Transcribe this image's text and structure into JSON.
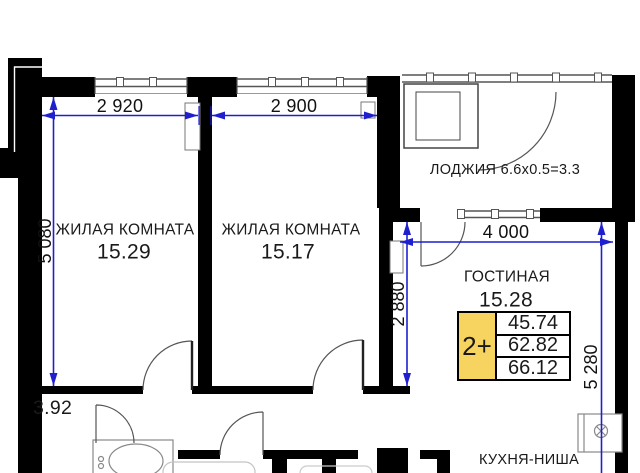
{
  "colors": {
    "wall": "#000000",
    "dimension_line": "#1f1fd0",
    "table_highlight": "#f7d45f"
  },
  "rooms": {
    "room1": {
      "label": "ЖИЛАЯ КОМНАТА",
      "area": "15.29"
    },
    "room2": {
      "label": "ЖИЛАЯ КОМНАТА",
      "area": "15.17"
    },
    "living": {
      "label": "ГОСТИНАЯ",
      "area": "15.28"
    },
    "loggia": {
      "label": "ЛОДЖИЯ 6.6x0.5=3.3"
    },
    "kitchen": {
      "label": "КУХНЯ-НИША"
    },
    "hall": {
      "area": "3.92"
    }
  },
  "dimensions": {
    "room1_width": "2 920",
    "room2_width": "2 900",
    "left_height": "5 080",
    "living_width": "4 000",
    "hall_height": "2 880",
    "right_height": "5 280"
  },
  "apartment_table": {
    "type": "2+",
    "rows": [
      "45.74",
      "62.82",
      "66.12"
    ]
  }
}
